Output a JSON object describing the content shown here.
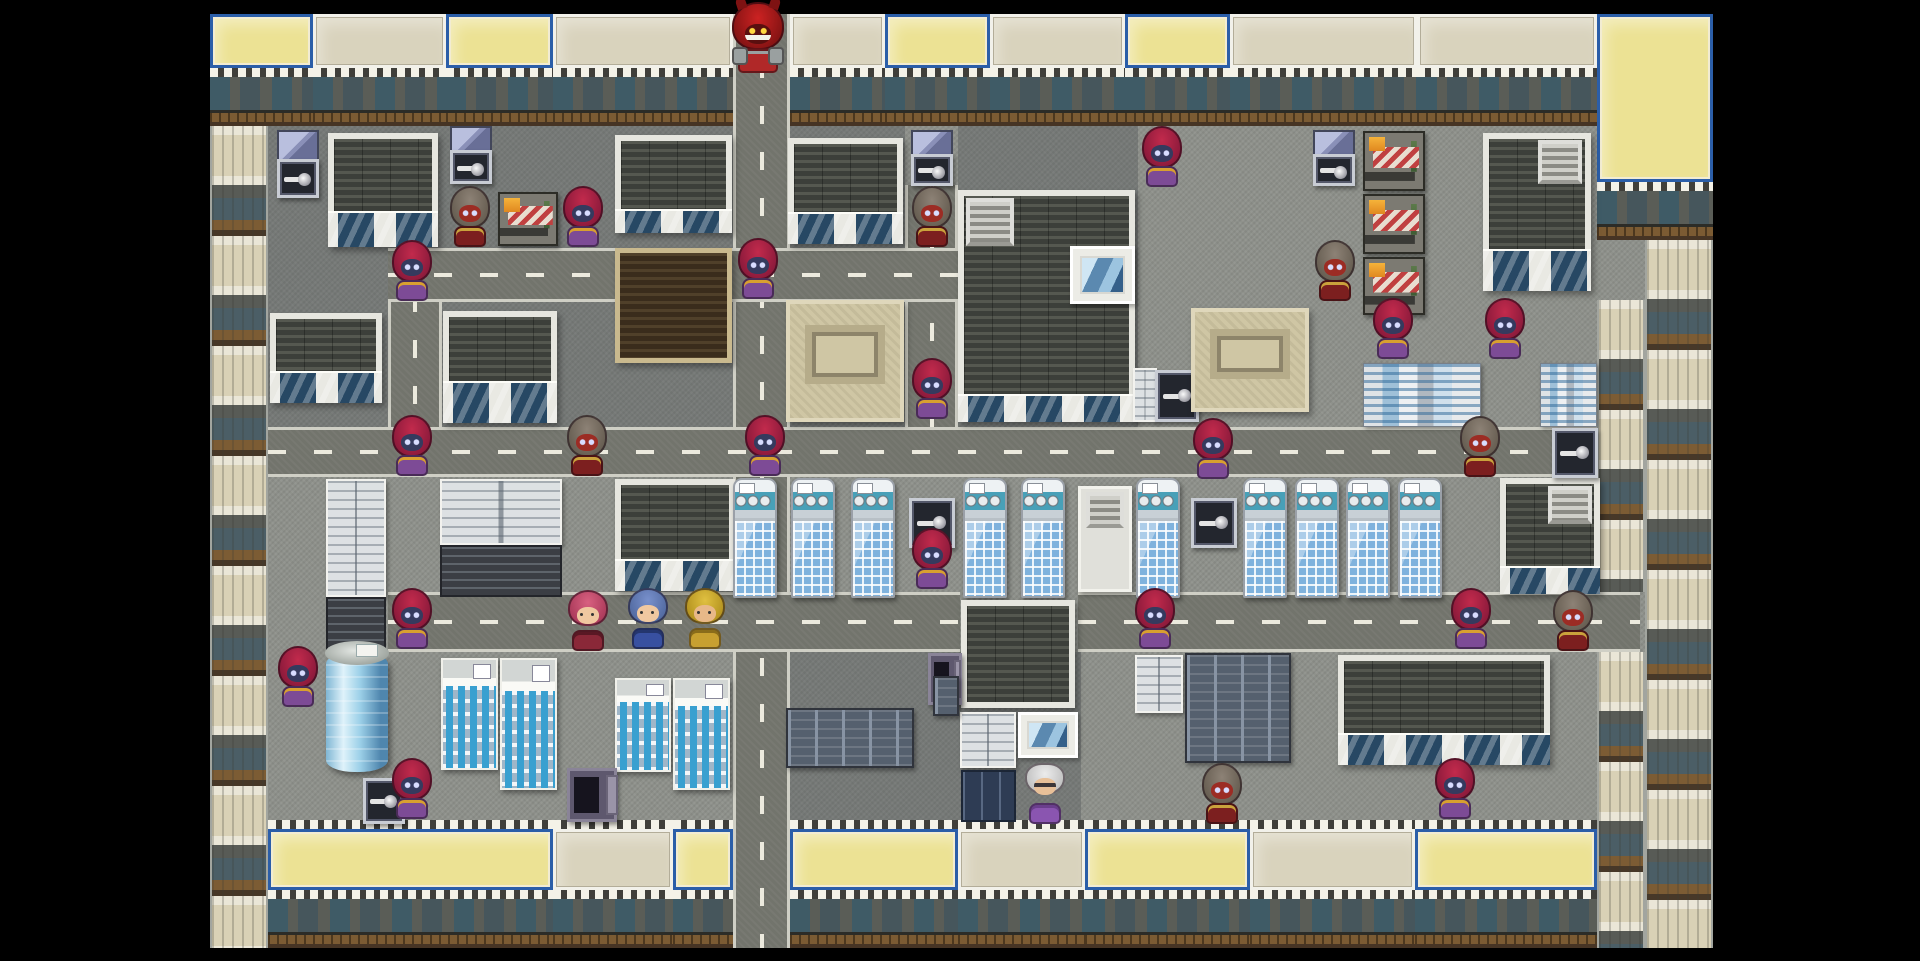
{
  "meta": {
    "screen": "rpg-city-map",
    "letterbox_color": "#000000",
    "viewport": {
      "x": 210,
      "y": 14,
      "w": 1503,
      "h": 934
    },
    "ground_color": "#8e918b",
    "road_color": "#72746c",
    "dash_color": "#eceade"
  },
  "roads": [
    {
      "dir": "v",
      "x": 733,
      "y": 14,
      "w": 57,
      "h": 934
    },
    {
      "dir": "v",
      "x": 388,
      "y": 248,
      "w": 54,
      "h": 229
    },
    {
      "dir": "v",
      "x": 905,
      "y": 185,
      "w": 53,
      "h": 292
    },
    {
      "dir": "h",
      "x": 268,
      "y": 427,
      "w": 1445,
      "h": 50
    },
    {
      "dir": "h",
      "x": 388,
      "y": 248,
      "w": 570,
      "h": 54
    },
    {
      "dir": "h",
      "x": 388,
      "y": 592,
      "w": 572,
      "h": 60
    },
    {
      "dir": "h",
      "x": 1078,
      "y": 592,
      "w": 562,
      "h": 60
    }
  ],
  "shades": [
    {
      "x": 268,
      "y": 126,
      "w": 465,
      "h": 122
    },
    {
      "x": 268,
      "y": 248,
      "w": 120,
      "h": 179
    },
    {
      "x": 442,
      "y": 302,
      "w": 291,
      "h": 125
    },
    {
      "x": 790,
      "y": 126,
      "w": 115,
      "h": 301
    },
    {
      "x": 958,
      "y": 126,
      "w": 180,
      "h": 301
    },
    {
      "x": 786,
      "y": 652,
      "w": 295,
      "h": 170
    }
  ],
  "props": [
    {
      "t": "storefront",
      "v": "yellow",
      "x": 210,
      "y": 14,
      "w": 103,
      "h": 112
    },
    {
      "t": "storefront",
      "v": "cream",
      "x": 313,
      "y": 14,
      "w": 133,
      "h": 112
    },
    {
      "t": "storefront",
      "v": "yellow",
      "x": 446,
      "y": 14,
      "w": 107,
      "h": 112
    },
    {
      "t": "storefront",
      "v": "cream",
      "x": 553,
      "y": 14,
      "w": 180,
      "h": 112
    },
    {
      "t": "storefront",
      "v": "cream",
      "x": 790,
      "y": 14,
      "w": 95,
      "h": 112
    },
    {
      "t": "storefront",
      "v": "yellow",
      "x": 885,
      "y": 14,
      "w": 105,
      "h": 112
    },
    {
      "t": "storefront",
      "v": "cream",
      "x": 990,
      "y": 14,
      "w": 135,
      "h": 112
    },
    {
      "t": "storefront",
      "v": "yellow",
      "x": 1125,
      "y": 14,
      "w": 105,
      "h": 112
    },
    {
      "t": "storefront",
      "v": "cream",
      "x": 1230,
      "y": 14,
      "w": 187,
      "h": 112
    },
    {
      "t": "storefront",
      "v": "cream",
      "x": 1417,
      "y": 14,
      "w": 180,
      "h": 112
    },
    {
      "t": "storefront",
      "v": "yellow",
      "x": 1597,
      "y": 14,
      "w": 116,
      "h": 226
    },
    {
      "t": "facade",
      "x": 210,
      "y": 126,
      "w": 58,
      "h": 822
    },
    {
      "t": "facade",
      "x": 1645,
      "y": 240,
      "w": 68,
      "h": 708
    },
    {
      "t": "facade",
      "x": 1597,
      "y": 300,
      "w": 48,
      "h": 292
    },
    {
      "t": "facade",
      "x": 1597,
      "y": 652,
      "w": 48,
      "h": 296
    },
    {
      "t": "storefront",
      "v": "yellow",
      "teeth": true,
      "x": 268,
      "y": 820,
      "w": 285,
      "h": 128
    },
    {
      "t": "storefront",
      "v": "cream",
      "teeth": true,
      "x": 553,
      "y": 820,
      "w": 120,
      "h": 128
    },
    {
      "t": "storefront",
      "v": "yellow",
      "teeth": true,
      "x": 673,
      "y": 820,
      "w": 60,
      "h": 128
    },
    {
      "t": "storefront",
      "v": "yellow",
      "teeth": true,
      "x": 790,
      "y": 820,
      "w": 168,
      "h": 128
    },
    {
      "t": "storefront",
      "v": "cream",
      "teeth": true,
      "x": 958,
      "y": 820,
      "w": 127,
      "h": 128
    },
    {
      "t": "storefront",
      "v": "yellow",
      "teeth": true,
      "x": 1085,
      "y": 820,
      "w": 165,
      "h": 128
    },
    {
      "t": "storefront",
      "v": "cream",
      "teeth": true,
      "x": 1250,
      "y": 820,
      "w": 165,
      "h": 128
    },
    {
      "t": "storefront",
      "v": "yellow",
      "teeth": true,
      "x": 1415,
      "y": 820,
      "w": 182,
      "h": 128
    },
    {
      "t": "safeglass",
      "x": 277,
      "y": 130,
      "w": 42,
      "h": 68
    },
    {
      "t": "roofdark",
      "win": 34,
      "x": 328,
      "y": 133,
      "w": 110,
      "h": 114
    },
    {
      "t": "roofdark",
      "win": 30,
      "x": 270,
      "y": 313,
      "w": 112,
      "h": 90
    },
    {
      "t": "roofdark",
      "win": 40,
      "x": 443,
      "y": 311,
      "w": 114,
      "h": 112
    },
    {
      "t": "safeglass",
      "x": 450,
      "y": 126,
      "w": 42,
      "h": 58
    },
    {
      "t": "stall",
      "x": 498,
      "y": 192,
      "w": 60,
      "h": 54
    },
    {
      "t": "roofdark",
      "win": 22,
      "x": 615,
      "y": 135,
      "w": 117,
      "h": 98
    },
    {
      "t": "roofbrown",
      "x": 615,
      "y": 248,
      "w": 117,
      "h": 115
    },
    {
      "t": "roofdark",
      "win": 30,
      "x": 788,
      "y": 138,
      "w": 115,
      "h": 106
    },
    {
      "t": "monument",
      "x": 786,
      "y": 300,
      "w": 118,
      "h": 122
    },
    {
      "t": "safeglass",
      "x": 911,
      "y": 130,
      "w": 42,
      "h": 56
    },
    {
      "t": "roofdark",
      "win": 26,
      "x": 958,
      "y": 190,
      "w": 177,
      "h": 232
    },
    {
      "t": "vent",
      "x": 966,
      "y": 198,
      "w": 48,
      "h": 48
    },
    {
      "t": "windowinset",
      "x": 1070,
      "y": 246,
      "w": 65,
      "h": 58
    },
    {
      "t": "cablight",
      "x": 1133,
      "y": 368,
      "w": 24,
      "h": 54
    },
    {
      "t": "safe",
      "x": 1155,
      "y": 370,
      "w": 44,
      "h": 52
    },
    {
      "t": "safeglass",
      "x": 1313,
      "y": 130,
      "w": 42,
      "h": 56
    },
    {
      "t": "stall",
      "x": 1363,
      "y": 131,
      "w": 62,
      "h": 60
    },
    {
      "t": "stall",
      "x": 1363,
      "y": 194,
      "w": 62,
      "h": 60
    },
    {
      "t": "stall",
      "x": 1363,
      "y": 257,
      "w": 62,
      "h": 58
    },
    {
      "t": "roofdark",
      "win": 40,
      "x": 1483,
      "y": 133,
      "w": 108,
      "h": 158
    },
    {
      "t": "vent",
      "x": 1538,
      "y": 140,
      "w": 44,
      "h": 44
    },
    {
      "t": "monument",
      "x": 1191,
      "y": 308,
      "w": 118,
      "h": 104
    },
    {
      "t": "minicity",
      "x": 1363,
      "y": 363,
      "w": 118,
      "h": 64
    },
    {
      "t": "minicity",
      "x": 1540,
      "y": 363,
      "w": 57,
      "h": 64
    },
    {
      "t": "cablight",
      "x": 326,
      "y": 479,
      "w": 60,
      "h": 118
    },
    {
      "t": "cabdark",
      "x": 326,
      "y": 597,
      "w": 60,
      "h": 55
    },
    {
      "t": "cablight",
      "x": 440,
      "y": 479,
      "w": 122,
      "h": 66
    },
    {
      "t": "cabdark",
      "x": 440,
      "y": 545,
      "w": 122,
      "h": 52
    },
    {
      "t": "roofdark",
      "win": 30,
      "x": 615,
      "y": 479,
      "w": 120,
      "h": 112
    },
    {
      "t": "rack",
      "x": 733,
      "y": 478,
      "w": 44,
      "h": 120
    },
    {
      "t": "rack",
      "x": 791,
      "y": 478,
      "w": 44,
      "h": 120
    },
    {
      "t": "rack",
      "x": 851,
      "y": 478,
      "w": 44,
      "h": 120
    },
    {
      "t": "safe",
      "x": 909,
      "y": 498,
      "w": 46,
      "h": 50
    },
    {
      "t": "rack",
      "x": 963,
      "y": 478,
      "w": 44,
      "h": 120
    },
    {
      "t": "rack",
      "x": 1021,
      "y": 478,
      "w": 44,
      "h": 120
    },
    {
      "t": "whitebld",
      "x": 1078,
      "y": 486,
      "w": 54,
      "h": 106
    },
    {
      "t": "vent",
      "x": 1086,
      "y": 492,
      "w": 38,
      "h": 36
    },
    {
      "t": "rack",
      "x": 1136,
      "y": 478,
      "w": 44,
      "h": 120
    },
    {
      "t": "safe",
      "x": 1191,
      "y": 498,
      "w": 46,
      "h": 50
    },
    {
      "t": "rack",
      "x": 1243,
      "y": 478,
      "w": 44,
      "h": 120
    },
    {
      "t": "rack",
      "x": 1295,
      "y": 478,
      "w": 44,
      "h": 120
    },
    {
      "t": "rack",
      "x": 1346,
      "y": 478,
      "w": 44,
      "h": 120
    },
    {
      "t": "rack",
      "x": 1398,
      "y": 478,
      "w": 44,
      "h": 120
    },
    {
      "t": "roofdark",
      "win": 26,
      "x": 1500,
      "y": 478,
      "w": 100,
      "h": 116
    },
    {
      "t": "vent",
      "x": 1548,
      "y": 486,
      "w": 44,
      "h": 38
    },
    {
      "t": "safe",
      "x": 1552,
      "y": 428,
      "w": 46,
      "h": 50
    },
    {
      "t": "cylinder",
      "x": 326,
      "y": 652,
      "w": 62,
      "h": 120
    },
    {
      "t": "minitower",
      "x": 441,
      "y": 658,
      "w": 57,
      "h": 112
    },
    {
      "t": "minitower",
      "x": 500,
      "y": 658,
      "w": 57,
      "h": 132
    },
    {
      "t": "minitower",
      "x": 615,
      "y": 678,
      "w": 56,
      "h": 94
    },
    {
      "t": "minitower",
      "x": 673,
      "y": 678,
      "w": 57,
      "h": 112
    },
    {
      "t": "safe",
      "x": 363,
      "y": 778,
      "w": 42,
      "h": 46
    },
    {
      "t": "safeopen",
      "x": 567,
      "y": 768,
      "w": 50,
      "h": 54
    },
    {
      "t": "roofdark",
      "win": 0,
      "x": 961,
      "y": 600,
      "w": 114,
      "h": 108
    },
    {
      "t": "cablight",
      "x": 960,
      "y": 712,
      "w": 56,
      "h": 56
    },
    {
      "t": "windowinset",
      "x": 1018,
      "y": 712,
      "w": 60,
      "h": 46
    },
    {
      "t": "doorsdark",
      "x": 961,
      "y": 770,
      "w": 55,
      "h": 52
    },
    {
      "t": "safeopen",
      "x": 928,
      "y": 653,
      "w": 34,
      "h": 52
    },
    {
      "t": "lockers",
      "x": 786,
      "y": 708,
      "w": 128,
      "h": 60
    },
    {
      "t": "lockers",
      "x": 933,
      "y": 676,
      "w": 26,
      "h": 40
    },
    {
      "t": "cablight",
      "x": 1135,
      "y": 655,
      "w": 48,
      "h": 58
    },
    {
      "t": "lockers",
      "x": 1185,
      "y": 653,
      "w": 106,
      "h": 110
    },
    {
      "t": "roofdark",
      "win": 30,
      "x": 1338,
      "y": 655,
      "w": 212,
      "h": 110
    }
  ],
  "sprite_types": {
    "red-hood": {
      "hood": "#c22a4c",
      "hoodDark": "#87193a",
      "face": "#353a5e",
      "body": "#7d4b96",
      "accent": "#d8a030"
    },
    "masked": {
      "hood": "#8d8276",
      "hoodDark": "#645b4f",
      "face": "#9c2c24",
      "body": "#7c1f1f",
      "accent": "#caa23c"
    },
    "boss-demon": {
      "hood": "#cc2222",
      "hoodDark": "#7e1212",
      "face": "#5a0f0f",
      "body": "#b02828",
      "accent": "#9aa0a0"
    },
    "old-man": {
      "hood": "#ececec",
      "hoodDark": "#bdbdbd",
      "face": "#e8c098",
      "body": "#8a55b0",
      "accent": "#6a3e8c"
    },
    "hero-pink": {
      "hood": "#d86080",
      "hoodDark": "#a83858",
      "face": "#f0c8a0",
      "body": "#8a2838",
      "accent": "#5a1824"
    },
    "hero-blue": {
      "hood": "#7890cc",
      "hoodDark": "#50689e",
      "face": "#f0c8a0",
      "body": "#3850a0",
      "accent": "#24366e"
    },
    "hero-gold": {
      "hood": "#e0c040",
      "hoodDark": "#b08f1e",
      "face": "#e8b888",
      "body": "#c8a030",
      "accent": "#8a6c1a"
    }
  },
  "sprites": [
    {
      "type": "boss-demon",
      "x": 758,
      "y": 74
    },
    {
      "type": "masked",
      "x": 470,
      "y": 248
    },
    {
      "type": "red-hood",
      "x": 583,
      "y": 248
    },
    {
      "type": "red-hood",
      "x": 412,
      "y": 302
    },
    {
      "type": "red-hood",
      "x": 758,
      "y": 300
    },
    {
      "type": "masked",
      "x": 932,
      "y": 248
    },
    {
      "type": "red-hood",
      "x": 1162,
      "y": 188
    },
    {
      "type": "masked",
      "x": 1335,
      "y": 302
    },
    {
      "type": "red-hood",
      "x": 1393,
      "y": 360
    },
    {
      "type": "red-hood",
      "x": 1505,
      "y": 360
    },
    {
      "type": "red-hood",
      "x": 932,
      "y": 420
    },
    {
      "type": "red-hood",
      "x": 412,
      "y": 477
    },
    {
      "type": "masked",
      "x": 587,
      "y": 477
    },
    {
      "type": "red-hood",
      "x": 765,
      "y": 477
    },
    {
      "type": "red-hood",
      "x": 1213,
      "y": 480
    },
    {
      "type": "masked",
      "x": 1480,
      "y": 478
    },
    {
      "type": "red-hood",
      "x": 932,
      "y": 590
    },
    {
      "type": "red-hood",
      "x": 412,
      "y": 650
    },
    {
      "type": "hero-pink",
      "x": 588,
      "y": 652
    },
    {
      "type": "hero-blue",
      "x": 648,
      "y": 650
    },
    {
      "type": "hero-gold",
      "x": 705,
      "y": 650
    },
    {
      "type": "red-hood",
      "x": 1155,
      "y": 650
    },
    {
      "type": "red-hood",
      "x": 1471,
      "y": 650
    },
    {
      "type": "masked",
      "x": 1573,
      "y": 652
    },
    {
      "type": "red-hood",
      "x": 298,
      "y": 708
    },
    {
      "type": "red-hood",
      "x": 412,
      "y": 820
    },
    {
      "type": "old-man",
      "x": 1045,
      "y": 825
    },
    {
      "type": "masked",
      "x": 1222,
      "y": 825
    },
    {
      "type": "red-hood",
      "x": 1455,
      "y": 820
    }
  ]
}
